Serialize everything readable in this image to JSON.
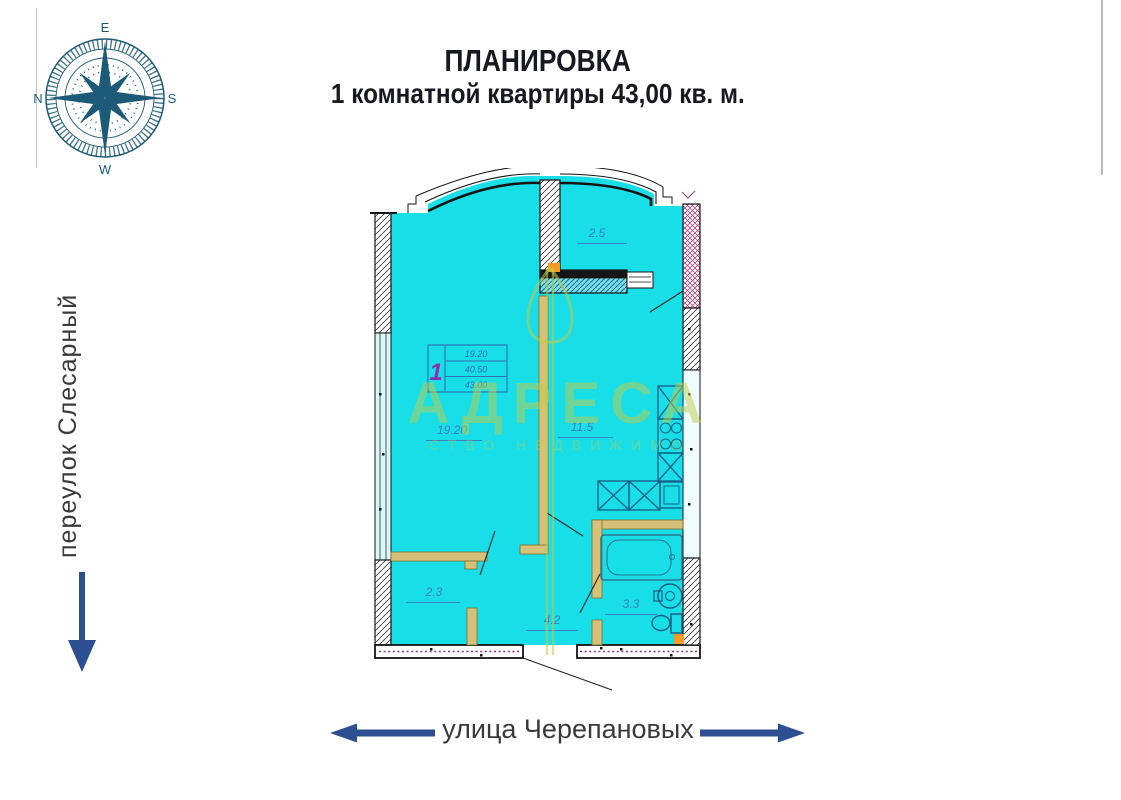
{
  "title": {
    "line1": "ПЛАНИРОВКА",
    "line2": "1 комнатной квартиры 43,00 кв. м."
  },
  "compass": {
    "top": "E",
    "right": "S",
    "bottom": "W",
    "left": "N"
  },
  "streets": {
    "left": {
      "label": "переулок Слесарный",
      "arrow_direction": "down"
    },
    "bottom": {
      "label": "улица Черепановых",
      "arrow_directions": "left and right"
    }
  },
  "plan": {
    "total_area_sqm": "43,00",
    "rooms": [
      {
        "name": "balcony",
        "area": "2.5"
      },
      {
        "name": "living-room",
        "area": "19.20"
      },
      {
        "name": "kitchen",
        "area": "11.5"
      },
      {
        "name": "wardrobe",
        "area": "2.3"
      },
      {
        "name": "hallway",
        "area": "4.2"
      },
      {
        "name": "bathroom",
        "area": "3.3"
      }
    ],
    "stamp": {
      "apartment_number": "1",
      "row1": "19.20",
      "row2": "40.50",
      "row3": "43.00"
    }
  },
  "watermark": {
    "text": "АДРЕСА",
    "subtext": "СТВО НЕДВИЖИМО"
  },
  "colors": {
    "floor_fill": "#18dee8",
    "wall_dark": "#141414",
    "partition_olive": "#d7c178",
    "label_blue": "#3f7fc1",
    "stamp_number_purple": "#8a2fae",
    "accent_navy": "#2b4f91",
    "compass_teal": "#1d5a78",
    "watermark_green": "#c1cb48",
    "fixture_orange": "#f59a23",
    "pink_hatch": "#b0487f"
  }
}
